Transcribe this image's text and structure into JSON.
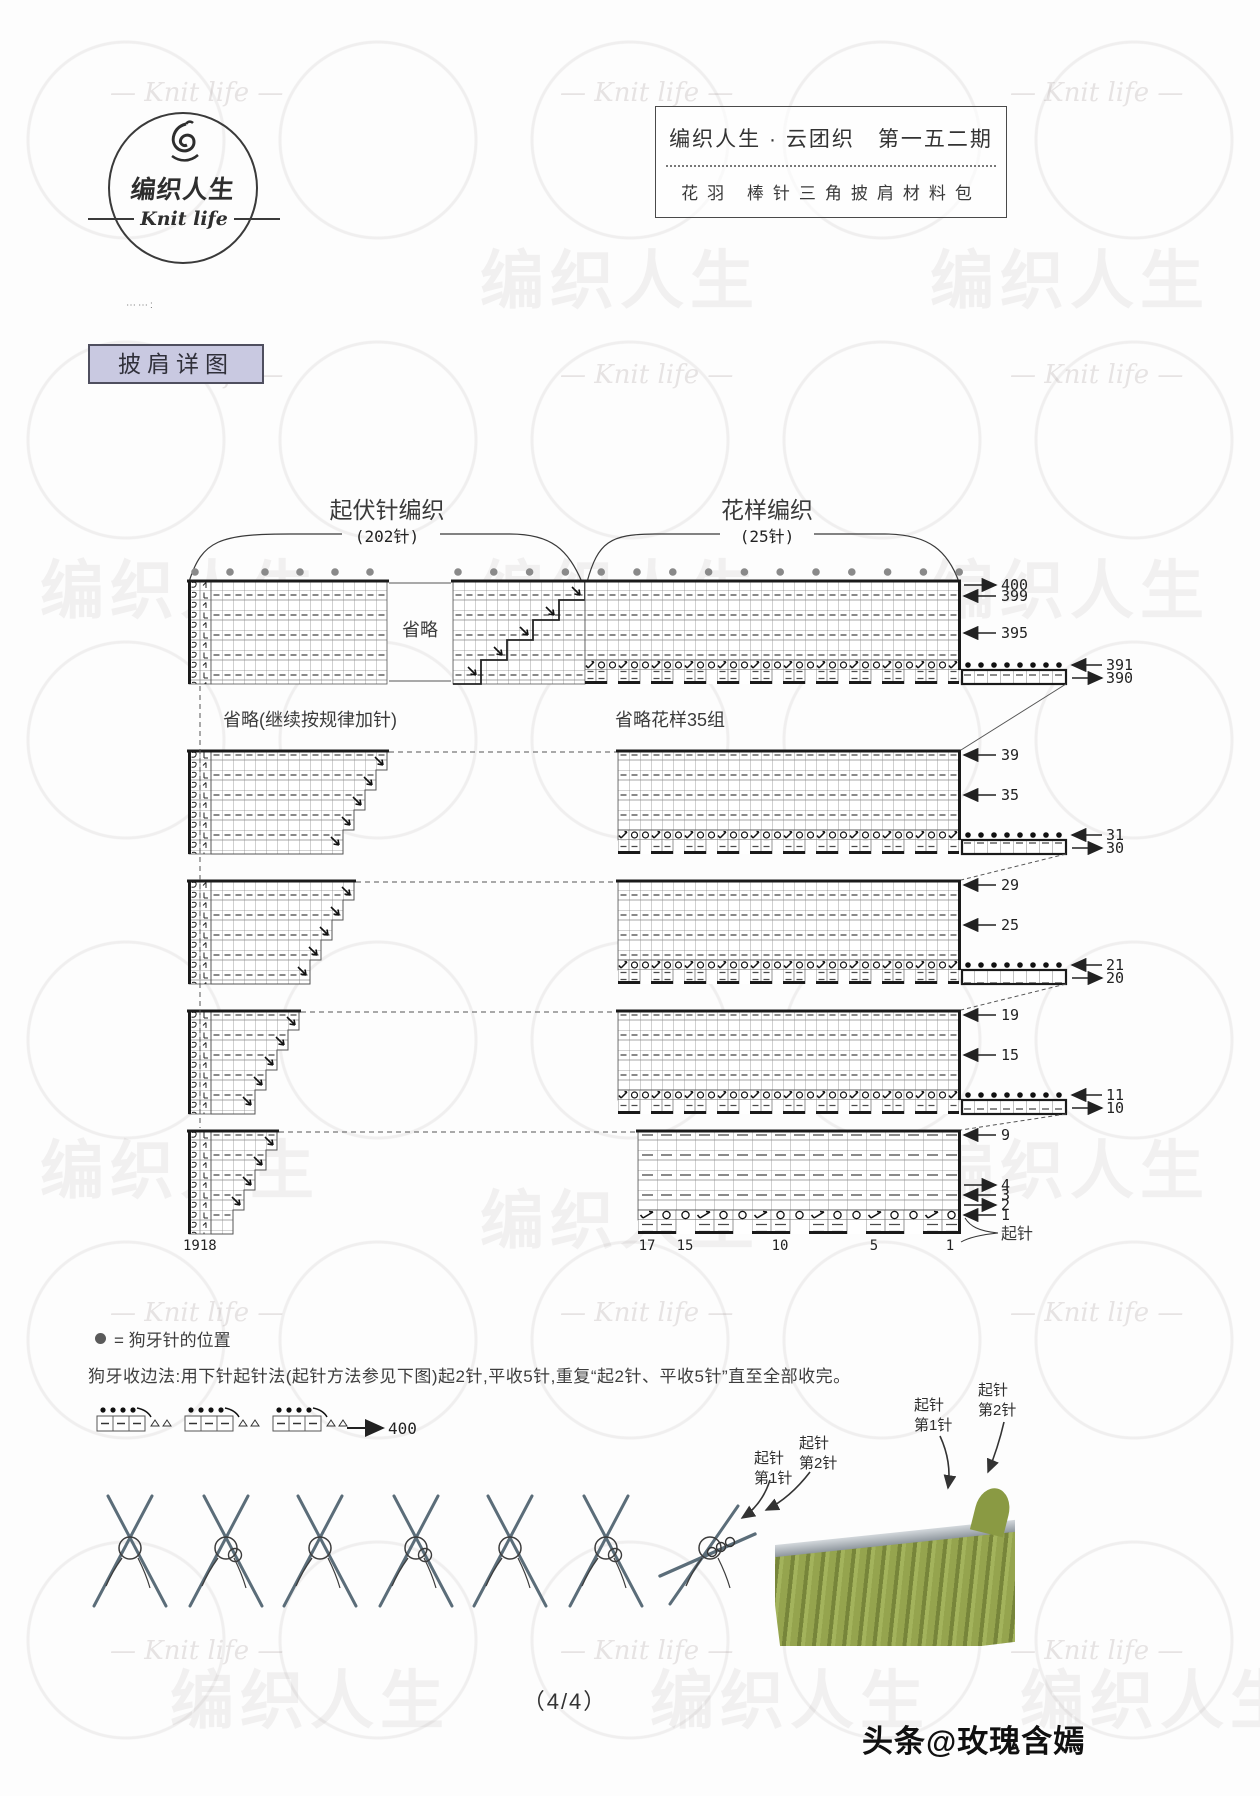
{
  "header": {
    "logo": {
      "cn": "编织人生",
      "en": "Knit life"
    },
    "box": {
      "line1": "编织人生 · 云团织　第一五二期",
      "line2": "花羽 棒针三角披肩材料包"
    }
  },
  "dots_note": "⋯⋯:",
  "section_label": "披肩详图",
  "chart": {
    "left_title": "起伏针编织",
    "left_count": "(202针)",
    "right_title": "花样编织",
    "right_count": "(25针)",
    "omit_mid": "省略",
    "omit_left": "省略(继续按规律加针)",
    "omit_right": "省略花样35组",
    "sections": [
      {
        "rows": [
          {
            "label": "400",
            "dir": "right"
          },
          {
            "label": "399",
            "dir": "left"
          },
          {
            "label": "395",
            "dir": "left"
          },
          {
            "label": "391",
            "dir": "left"
          },
          {
            "label": "390",
            "dir": "right"
          }
        ]
      },
      {
        "rows": [
          {
            "label": "39",
            "dir": "left"
          },
          {
            "label": "35",
            "dir": "left"
          },
          {
            "label": "31",
            "dir": "left"
          },
          {
            "label": "30",
            "dir": "right"
          }
        ]
      },
      {
        "rows": [
          {
            "label": "29",
            "dir": "left"
          },
          {
            "label": "25",
            "dir": "left"
          },
          {
            "label": "21",
            "dir": "left"
          },
          {
            "label": "20",
            "dir": "right"
          }
        ]
      },
      {
        "rows": [
          {
            "label": "19",
            "dir": "left"
          },
          {
            "label": "15",
            "dir": "left"
          },
          {
            "label": "11",
            "dir": "left"
          },
          {
            "label": "10",
            "dir": "right"
          }
        ]
      },
      {
        "rows": [
          {
            "label": "9",
            "dir": "left"
          },
          {
            "label": "4",
            "dir": "right"
          },
          {
            "label": "3",
            "dir": "left"
          },
          {
            "label": "2",
            "dir": "right"
          },
          {
            "label": "1",
            "dir": "left"
          }
        ]
      }
    ],
    "cast_on_label": "起针",
    "bottom_numbers": [
      "1918",
      "17",
      "15",
      "10",
      "5",
      "1"
    ]
  },
  "legend": {
    "symbol": "●",
    "text": "= 狗牙针的位置"
  },
  "instruction": "狗牙收边法:用下针起针法(起针方法参见下图)起2针,平收5针,重复“起2针、平收5针”直至全部收完。",
  "strip": {
    "end_number": "400"
  },
  "cast_labels": {
    "l1a": "起针",
    "l1b": "第1针",
    "l2a": "起针",
    "l2b": "第2针"
  },
  "page_number": "（4/4）",
  "credit": "头条@玫瑰含嫣",
  "watermark": {
    "cn": "编织人生",
    "en": "Knit life"
  }
}
